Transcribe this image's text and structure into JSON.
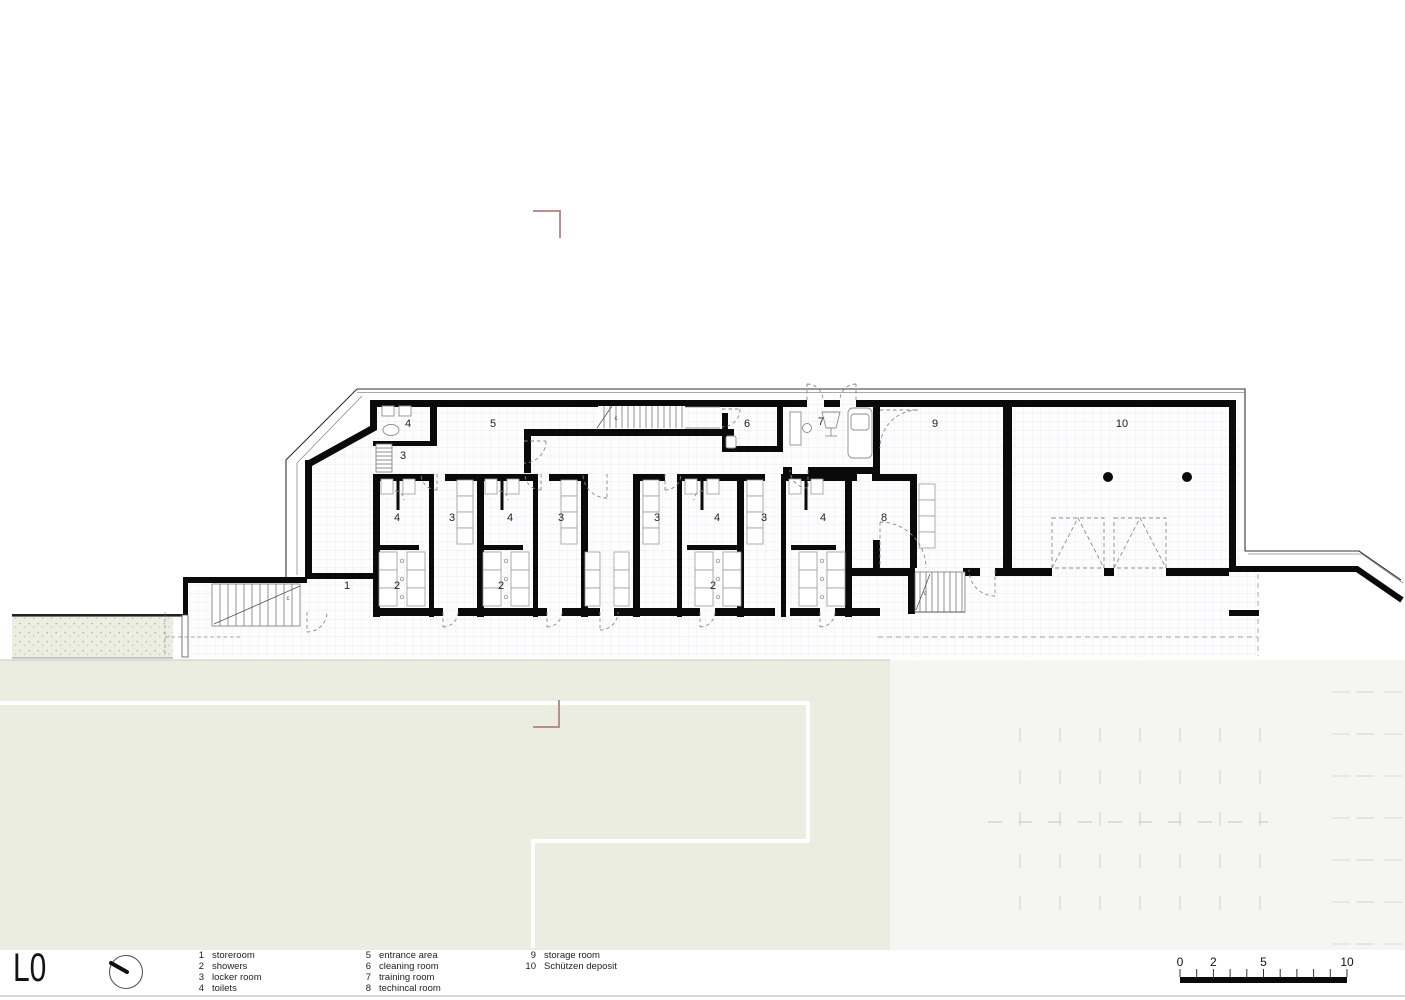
{
  "title": "L0",
  "legend": {
    "columns": [
      {
        "items": [
          {
            "num": "1",
            "label": "storeroom"
          },
          {
            "num": "2",
            "label": "showers"
          },
          {
            "num": "3",
            "label": "locker room"
          },
          {
            "num": "4",
            "label": "toilets"
          }
        ]
      },
      {
        "items": [
          {
            "num": "5",
            "label": "entrance area"
          },
          {
            "num": "6",
            "label": "cleaning room"
          },
          {
            "num": "7",
            "label": "training room"
          },
          {
            "num": "8",
            "label": "techincal room"
          }
        ]
      },
      {
        "items": [
          {
            "num": "9",
            "label": "storage room"
          },
          {
            "num": "10",
            "label": "Schützen deposit"
          }
        ]
      }
    ]
  },
  "plan": {
    "room_labels": [
      {
        "n": "4",
        "x": 408,
        "y": 427
      },
      {
        "n": "3",
        "x": 403,
        "y": 459
      },
      {
        "n": "5",
        "x": 493,
        "y": 427
      },
      {
        "n": "6",
        "x": 747,
        "y": 427
      },
      {
        "n": "7",
        "x": 821,
        "y": 425
      },
      {
        "n": "9",
        "x": 935,
        "y": 427
      },
      {
        "n": "10",
        "x": 1122,
        "y": 427
      },
      {
        "n": "4",
        "x": 397,
        "y": 521
      },
      {
        "n": "3",
        "x": 452,
        "y": 521
      },
      {
        "n": "4",
        "x": 510,
        "y": 521
      },
      {
        "n": "3",
        "x": 561,
        "y": 521
      },
      {
        "n": "3",
        "x": 657,
        "y": 521
      },
      {
        "n": "4",
        "x": 717,
        "y": 521
      },
      {
        "n": "3",
        "x": 764,
        "y": 521
      },
      {
        "n": "4",
        "x": 823,
        "y": 521
      },
      {
        "n": "8",
        "x": 884,
        "y": 521
      },
      {
        "n": "1",
        "x": 347,
        "y": 589
      },
      {
        "n": "2",
        "x": 397,
        "y": 589
      },
      {
        "n": "2",
        "x": 501,
        "y": 589
      },
      {
        "n": "2",
        "x": 713,
        "y": 589
      }
    ],
    "small_labels": [
      {
        "n": "c",
        "x": 616,
        "y": 420
      },
      {
        "n": "c",
        "x": 288,
        "y": 600
      },
      {
        "n": "c",
        "x": 925,
        "y": 595
      }
    ]
  },
  "scalebar": {
    "labels": [
      {
        "text": "0",
        "meters": 0
      },
      {
        "text": "2",
        "meters": 2
      },
      {
        "text": "5",
        "meters": 5
      },
      {
        "text": "10",
        "meters": 10
      }
    ],
    "total_meters": 10
  },
  "colors": {
    "wall": "#0a0a0a",
    "grass": "#ecede1",
    "paving": "#f5f5f2",
    "grid_line": "#e3e3ea",
    "marker_red": "#b98f8f"
  }
}
